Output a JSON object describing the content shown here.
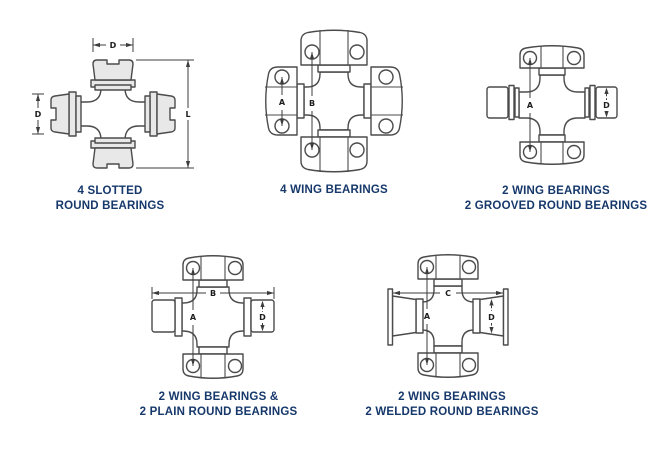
{
  "colors": {
    "caption": "#16386b",
    "line_art": "#4b4b4b",
    "dimension": "#3d3d3d",
    "cap_fill": "#e8e8e8",
    "background": "#ffffff"
  },
  "figures": [
    {
      "caption_lines": [
        "4 SLOTTED",
        "ROUND BEARINGS"
      ],
      "dims": {
        "d_top": "D",
        "d_left": "D",
        "l_right": "L"
      }
    },
    {
      "caption_lines": [
        "4 WING BEARINGS",
        ""
      ],
      "dims": {
        "a": "A",
        "b": "B"
      }
    },
    {
      "caption_lines": [
        "2 WING BEARINGS",
        "2 GROOVED ROUND BEARINGS"
      ],
      "dims": {
        "a": "A",
        "d": "D"
      }
    },
    {
      "caption_lines": [
        "2 WING BEARINGS &",
        "2 PLAIN ROUND BEARINGS"
      ],
      "dims": {
        "a": "A",
        "b": "B",
        "d": "D"
      }
    },
    {
      "caption_lines": [
        "2 WING BEARINGS",
        "2 WELDED ROUND BEARINGS"
      ],
      "dims": {
        "a": "A",
        "c": "C",
        "d": "D"
      }
    }
  ]
}
